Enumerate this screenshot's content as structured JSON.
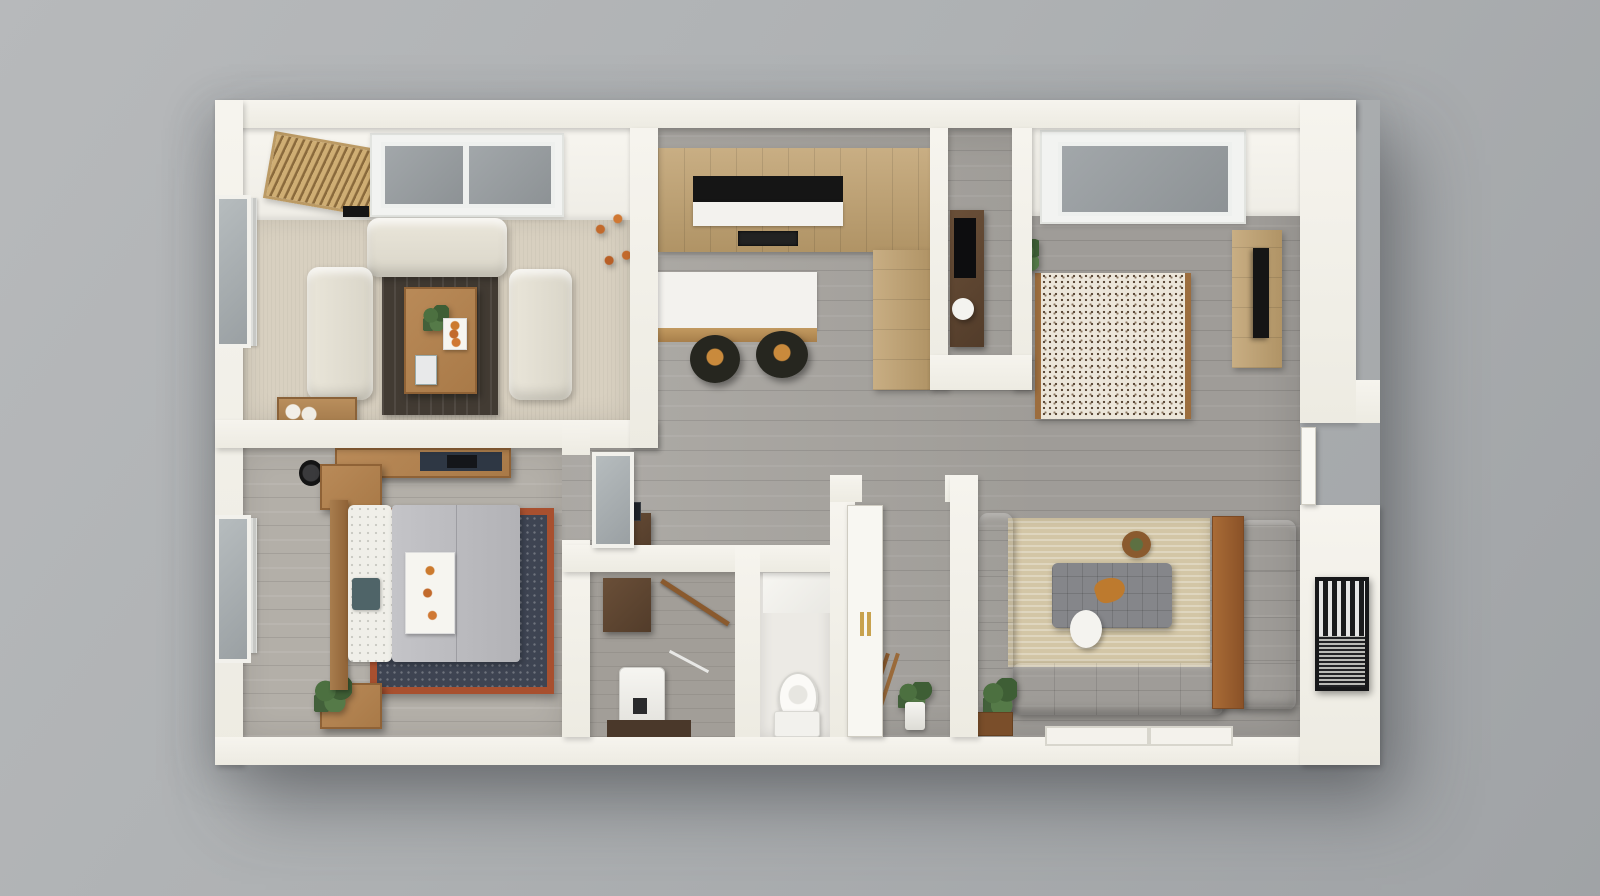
{
  "scene": {
    "kind": "3d-floor-plan-render",
    "view": "top-down isometric dollhouse",
    "units": "one-bedroom apartment"
  },
  "palette": {
    "background_gray": "#aeb1b3",
    "wall_white": "#f2f0e9",
    "floor_wood_gray": "#a9a6a1",
    "floor_wood_bedroom": "#b3afa8",
    "carpet_beige": "#d8d0c0",
    "tile_white": "#eceae5",
    "cabinet_oak": "#bfa06e",
    "counter_white": "#f3f2ee",
    "appliance_black": "#151515",
    "sofa_cream": "#e6e2d6",
    "rug_espresso": "#423b33",
    "coffee_table_wood": "#a97a48",
    "rug_navy": "#3e4452",
    "rug_navy_border": "#a8502f",
    "duvet_gray": "#b9b9bc",
    "rug_speckled_base": "#ece6da",
    "rug_speckled_border": "#9c6d3e",
    "rug_tan": "#d3c6a6",
    "sectional_taupe": "#8f8478",
    "console_wood": "#9c5f2e",
    "utility_cabinet_wood": "#5c4431",
    "fixture_white": "#fbfaf7",
    "glass_gray": "#9aa0a3",
    "plant_green": "#4c7040",
    "flower_orange": "#c26a2c",
    "door_handle_gold": "#c8a24e",
    "skylight_glass": "#979da0"
  },
  "rooms": [
    {
      "id": "living-room",
      "name": "Living room (cream sofas, skylights)",
      "floor": "beige carpet"
    },
    {
      "id": "kitchen",
      "name": "Kitchen (oak cabinets, island with stools)",
      "floor": "gray wood"
    },
    {
      "id": "office-nook",
      "name": "Office nook (desk and lamp)",
      "floor": "gray wood"
    },
    {
      "id": "media-room",
      "name": "Media room (speckled rug, TV cabinet, skylight)",
      "floor": "gray wood"
    },
    {
      "id": "bedroom",
      "name": "Bedroom (bed on navy rug, window)",
      "floor": "gray wood"
    },
    {
      "id": "hallway",
      "name": "Hallway / open great room",
      "floor": "gray wood"
    },
    {
      "id": "utility-closet",
      "name": "Utility closet (appliance, hanging rod)",
      "floor": "gray wood"
    },
    {
      "id": "toilet-room",
      "name": "Toilet room",
      "floor": "white tile"
    },
    {
      "id": "entry",
      "name": "Entry (open door, plant, ladder)",
      "floor": "gray wood"
    },
    {
      "id": "family-room",
      "name": "Family room (gray sectional, tan rug, wall art)",
      "floor": "gray wood"
    }
  ],
  "furniture": {
    "living_room": [
      "wood-slat mat",
      "double skylight",
      "ceiling vent",
      "cream sofa",
      "two cream loveseats",
      "espresso rug",
      "wood coffee table with plants and tray",
      "corner plant with orange flowers",
      "wood crate with ornaments",
      "window with curtain"
    ],
    "kitchen": [
      "upper oak cabinets",
      "black cooktop with hood",
      "white counter",
      "oven",
      "tall pantry cabinet",
      "island with white countertop",
      "two black bar stools with orange plates"
    ],
    "office_nook": [
      "dark desk",
      "white desk lamp"
    ],
    "media_room": [
      "skylight",
      "brown speckled rug",
      "oak TV cabinet",
      "wall TV",
      "small plant"
    ],
    "bedroom": [
      "double bed with gray duvet",
      "white patterned pillows",
      "teal cushion",
      "breakfast tray",
      "navy rug with rust border",
      "wood headboard",
      "two nightstands",
      "potted plant",
      "black speaker",
      "wall desk with navy mat",
      "window with curtain"
    ],
    "hallway": [
      "glass-panel bedroom door",
      "dark dresser with frame"
    ],
    "utility_closet": [
      "dark wood cabinet",
      "white appliance",
      "wooden hanging rod",
      "wire shelf",
      "dark floor mat"
    ],
    "toilet_room": [
      "toilet",
      "marble splash panel"
    ],
    "entry": [
      "open white door with gold handles",
      "leaning ladder",
      "plant in white pot"
    ],
    "family_room": [
      "tan area rug",
      "gray sectional sofa",
      "gray armchair sofa",
      "tufted gray ottoman",
      "white side table",
      "round basket",
      "wood console",
      "plant with wood box",
      "window seat",
      "black framed artwork",
      "exterior door in right wall"
    ]
  },
  "counts": {
    "skylights": 3,
    "bar_stools": 2,
    "sofas_cream": 3,
    "doors_visible": 3
  }
}
